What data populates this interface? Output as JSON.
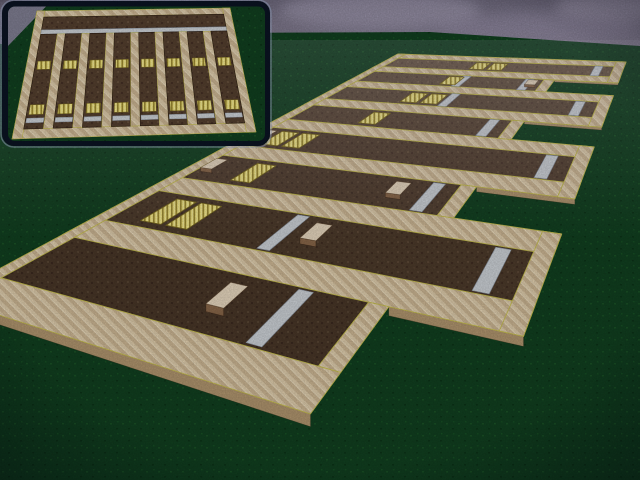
{
  "scene": {
    "type": "voxel-farm-3d-view",
    "viewport": {
      "width": 640,
      "height": 480
    },
    "colors": {
      "sky_top": "#6e697d",
      "sky_base": "#968fa4",
      "cloud_light": "#b2a9c2",
      "cloud_mid": "#a89fb8",
      "cloud_dark": "#7b7589",
      "grass": "#114020",
      "grass_dark": "#0a2d15",
      "path": "#e0cead",
      "path_stripe": "#cdb794",
      "path_side": "#b1966f",
      "path_edge": "#c9c052",
      "soil": "#55402f",
      "soil_dark": "#463126",
      "soil_light": "#66503c",
      "soil_stroke": "#2e1f14",
      "crop": "#f0e27b",
      "crop_stripe": "#9e8c34",
      "water": "#ced3d8",
      "water_stroke": "#8d97a5",
      "block_top": "#e9d9c0",
      "block_front": "#8a684a",
      "inset_border": "#0b1423",
      "inset_highlight": "#a0b0cc",
      "inset_grass": "#0d3a1c",
      "inset_sky": "#8d86a0"
    },
    "main_farm": {
      "bed_count": 8,
      "plan_width": 27,
      "plan_height": 25,
      "body_east_end": 20,
      "tooth_east_end": 26,
      "beds": [
        {
          "tooth": true,
          "crops": [
            12,
            14
          ],
          "waters": [
            24.5
          ],
          "blocks": []
        },
        {
          "tooth": false,
          "crops": [
            11
          ],
          "waters": [
            12,
            18.6
          ],
          "blocks": [
            19.2
          ]
        },
        {
          "tooth": true,
          "crops": [
            9.5,
            11.5
          ],
          "waters": [
            13,
            24.5
          ],
          "blocks": []
        },
        {
          "tooth": false,
          "crops": [
            8.5
          ],
          "waters": [
            18.6
          ],
          "blocks": []
        },
        {
          "tooth": true,
          "crops": [
            3.2,
            5.2
          ],
          "waters": [
            24.5
          ],
          "blocks": [
            1.8
          ]
        },
        {
          "tooth": false,
          "crops": [
            5.5
          ],
          "waters": [
            18.6
          ],
          "blocks": [
            2.0,
            16.6
          ]
        },
        {
          "tooth": true,
          "crops": [
            4,
            6
          ],
          "waters": [
            12.5,
            24.5
          ],
          "blocks": [
            14.6
          ]
        },
        {
          "tooth": false,
          "crops": [],
          "waters": [
            16.8
          ],
          "blocks": [
            13.8
          ]
        }
      ]
    },
    "minimap": {
      "columns": 8,
      "plan_width": 25,
      "plan_height": 16.5,
      "has_header_bed": true,
      "header_water_row": true,
      "column_crop_positions": [
        8.0,
        13.4
      ],
      "column_water_v": 14.35
    }
  }
}
